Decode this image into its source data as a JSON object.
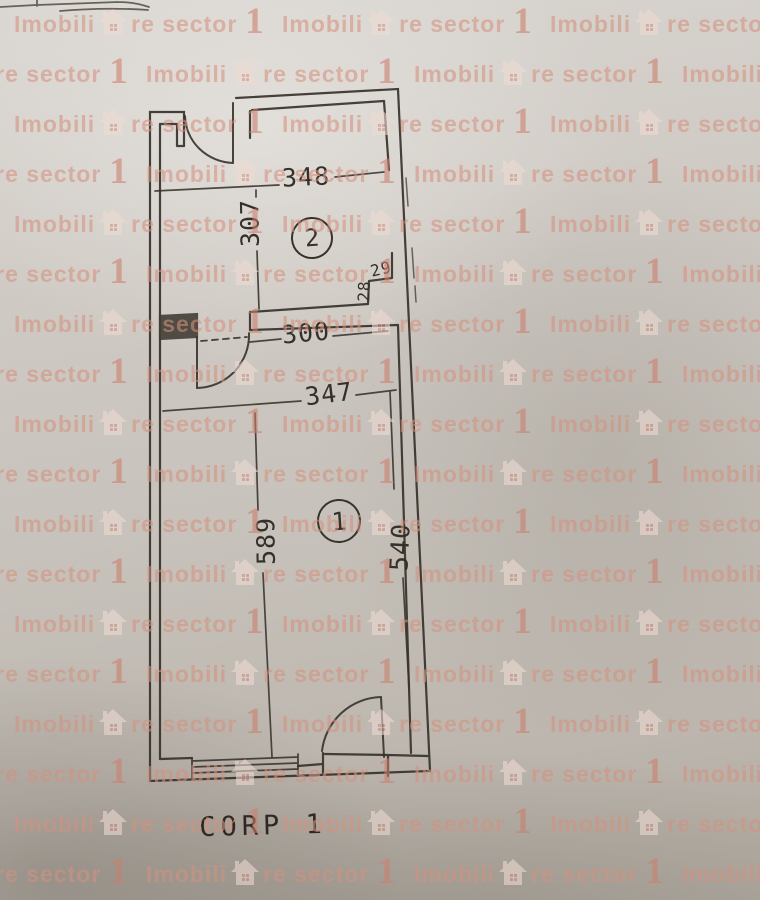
{
  "floorplan": {
    "title": "CORP 1",
    "rooms": [
      {
        "number": "2"
      },
      {
        "number": "1"
      }
    ],
    "dimensions": [
      {
        "label": "348",
        "orientation": "horizontal"
      },
      {
        "label": "307",
        "orientation": "vertical"
      },
      {
        "label": "29",
        "orientation": "horizontal"
      },
      {
        "label": "28",
        "orientation": "vertical"
      },
      {
        "label": "300",
        "orientation": "horizontal"
      },
      {
        "label": "347",
        "orientation": "horizontal"
      },
      {
        "label": "589",
        "orientation": "vertical"
      },
      {
        "label": "540",
        "orientation": "vertical"
      }
    ]
  },
  "watermark": {
    "text_before_icon": "Imobili",
    "text_after_icon": "re sector",
    "suffix": "1",
    "icon": "house-icon",
    "text_color": "#d5917f",
    "suffix_color": "#cb7f6c",
    "icon_color": "#eedbd3",
    "icon_window_color": "#cf9384"
  },
  "paper": {
    "background_color": "#c7c2bb",
    "ink_color": "#37322b"
  }
}
